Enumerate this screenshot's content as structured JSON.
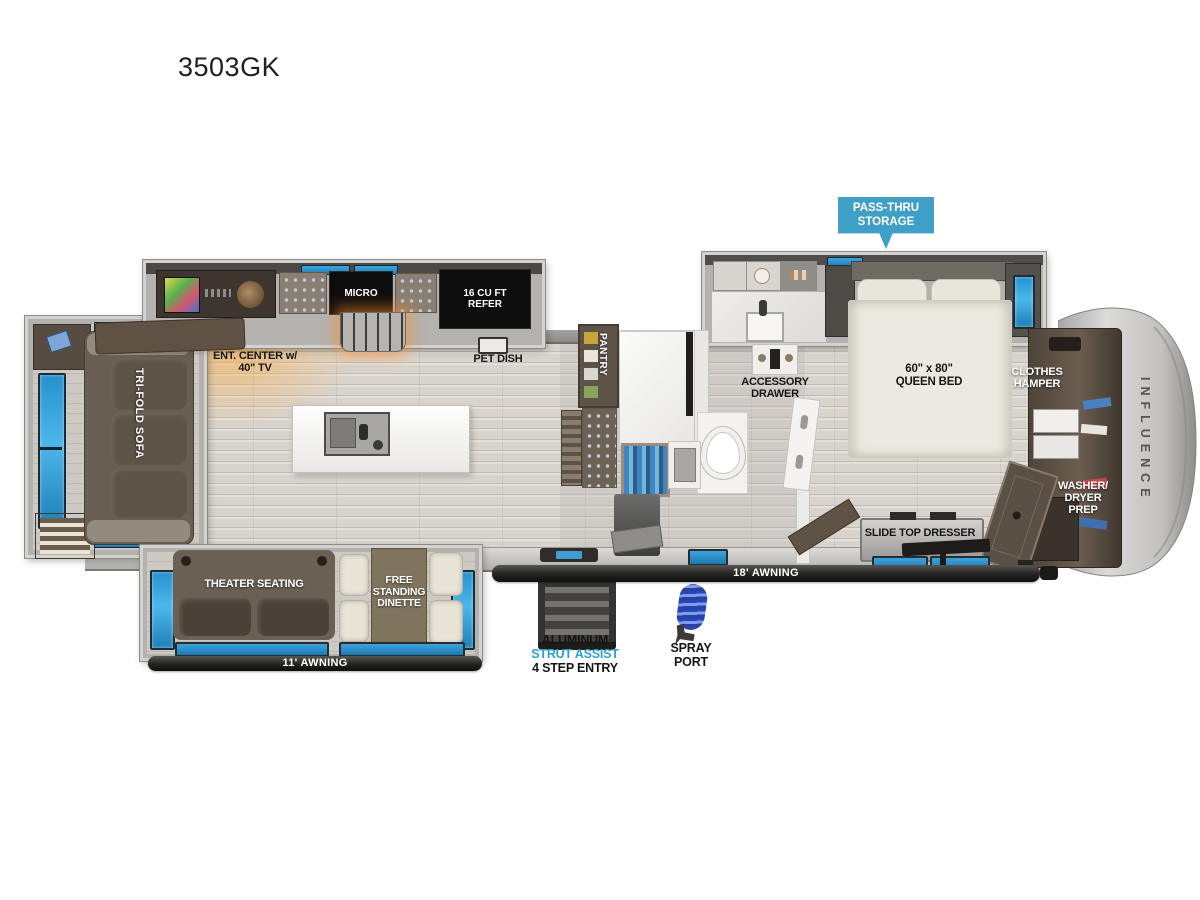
{
  "page": {
    "title": "3503GK"
  },
  "callout": {
    "line1": "PASS-THRU",
    "line2": "STORAGE"
  },
  "kitchen": {
    "micro": "MICRO",
    "refer_line1": "16 CU FT",
    "refer_line2": "REFER",
    "pet_dish": "PET DISH",
    "ent_line1": "ENT. CENTER w/",
    "ent_line2": "40\" TV"
  },
  "living": {
    "sofa": "TRI-FOLD SOFA",
    "theater": "THEATER SEATING",
    "dinette_line1": "FREE",
    "dinette_line2": "STANDING",
    "dinette_line3": "DINETTE"
  },
  "bath": {
    "pantry": "PANTRY",
    "acc_line1": "ACCESSORY",
    "acc_line2": "DRAWER"
  },
  "bedroom": {
    "bed_line1": "60\" x 80\"",
    "bed_line2": "QUEEN BED",
    "hamper_line1": "CLOTHES",
    "hamper_line2": "HAMPER",
    "wd_line1": "WASHER/",
    "wd_line2": "DRYER",
    "wd_line3": "PREP",
    "dresser": "SLIDE TOP DRESSER"
  },
  "exterior": {
    "awning_main": "18' AWNING",
    "awning_rear": "11' AWNING",
    "entry_line1": "ALUMINUM",
    "entry_line2": "STRUT ASSIST",
    "entry_line3": "4 STEP ENTRY",
    "spray_line1": "SPRAY",
    "spray_line2": "PORT",
    "brand": "INFLUENCE"
  },
  "colors": {
    "callout_blue": "#3f9fc6",
    "window_blue": "#2f9cd8",
    "strut_text_blue": "#2f9fd4"
  }
}
